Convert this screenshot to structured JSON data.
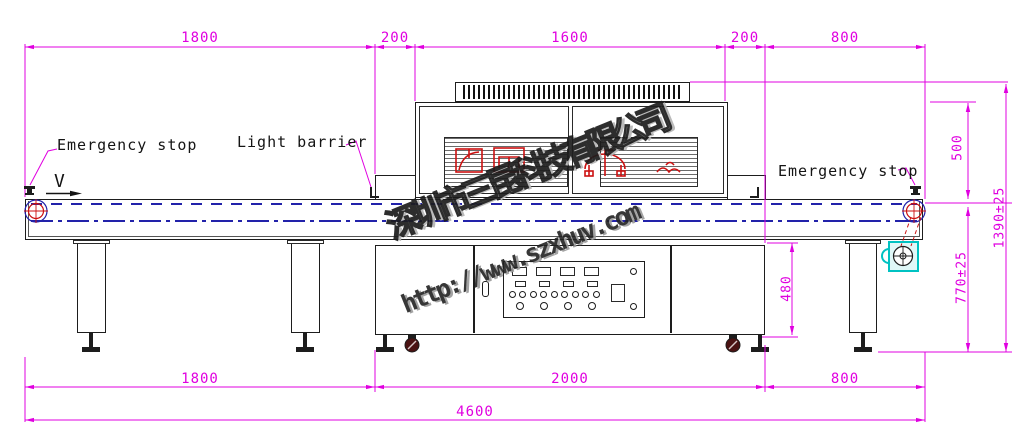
{
  "labels": {
    "emergency_stop_left": "Emergency stop",
    "light_barrier": "Light barrier",
    "emergency_stop_right": "Emergency stop",
    "direction": "V"
  },
  "dimensions": {
    "top": [
      "1800",
      "200",
      "1600",
      "200",
      "800"
    ],
    "bottom": [
      "1800",
      "2000",
      "800"
    ],
    "overall_length": "4600",
    "right": {
      "lamp_housing_height": "500",
      "overall_height": "1390±25",
      "belt_height": "770±25",
      "cabinet_height": "480"
    }
  },
  "watermark": {
    "company": "深圳市三昆科技有限公司",
    "website": "http://www.szxhuv.com"
  },
  "colors": {
    "dimension_magenta": "#e000e0",
    "centerline_blue": "#2222aa",
    "logo_red": "#cc1111",
    "motor_cyan": "#00c2c2"
  }
}
